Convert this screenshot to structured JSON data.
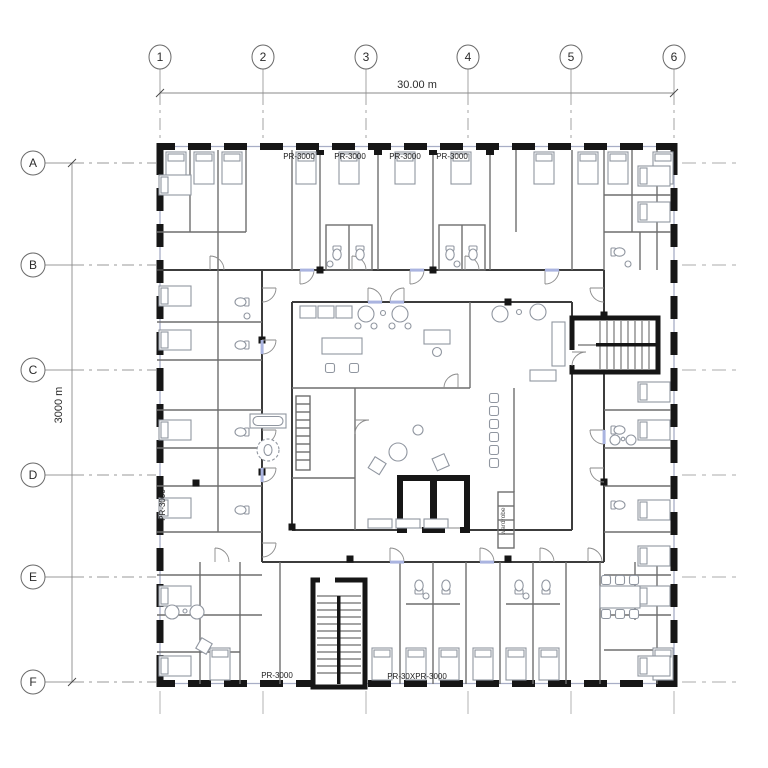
{
  "annotations": {
    "grid_columns": [
      "1",
      "2",
      "3",
      "4",
      "5",
      "6"
    ],
    "grid_rows": [
      "A",
      "B",
      "C",
      "D",
      "E",
      "F"
    ],
    "dim_top": "30.00 m",
    "dim_left": "3000 m",
    "unit_labels_top": [
      "PR-3000",
      "PR-3000",
      "PR-3000",
      "PR-3000"
    ],
    "unit_label_bottom_left": "PR-3000",
    "unit_label_bottom_right": "PR-30XPR-3000",
    "unit_label_left_vertical": "PR-3000",
    "core_label_vertical": "wardrobe"
  },
  "colors": {
    "exterior_wall": "#161616",
    "ring_wall": "#3c3c3c",
    "partition": "#6e6e6e",
    "furniture": "#9096a0",
    "grid_line": "#9a9a9a",
    "door_sill": "#aab4e0"
  }
}
